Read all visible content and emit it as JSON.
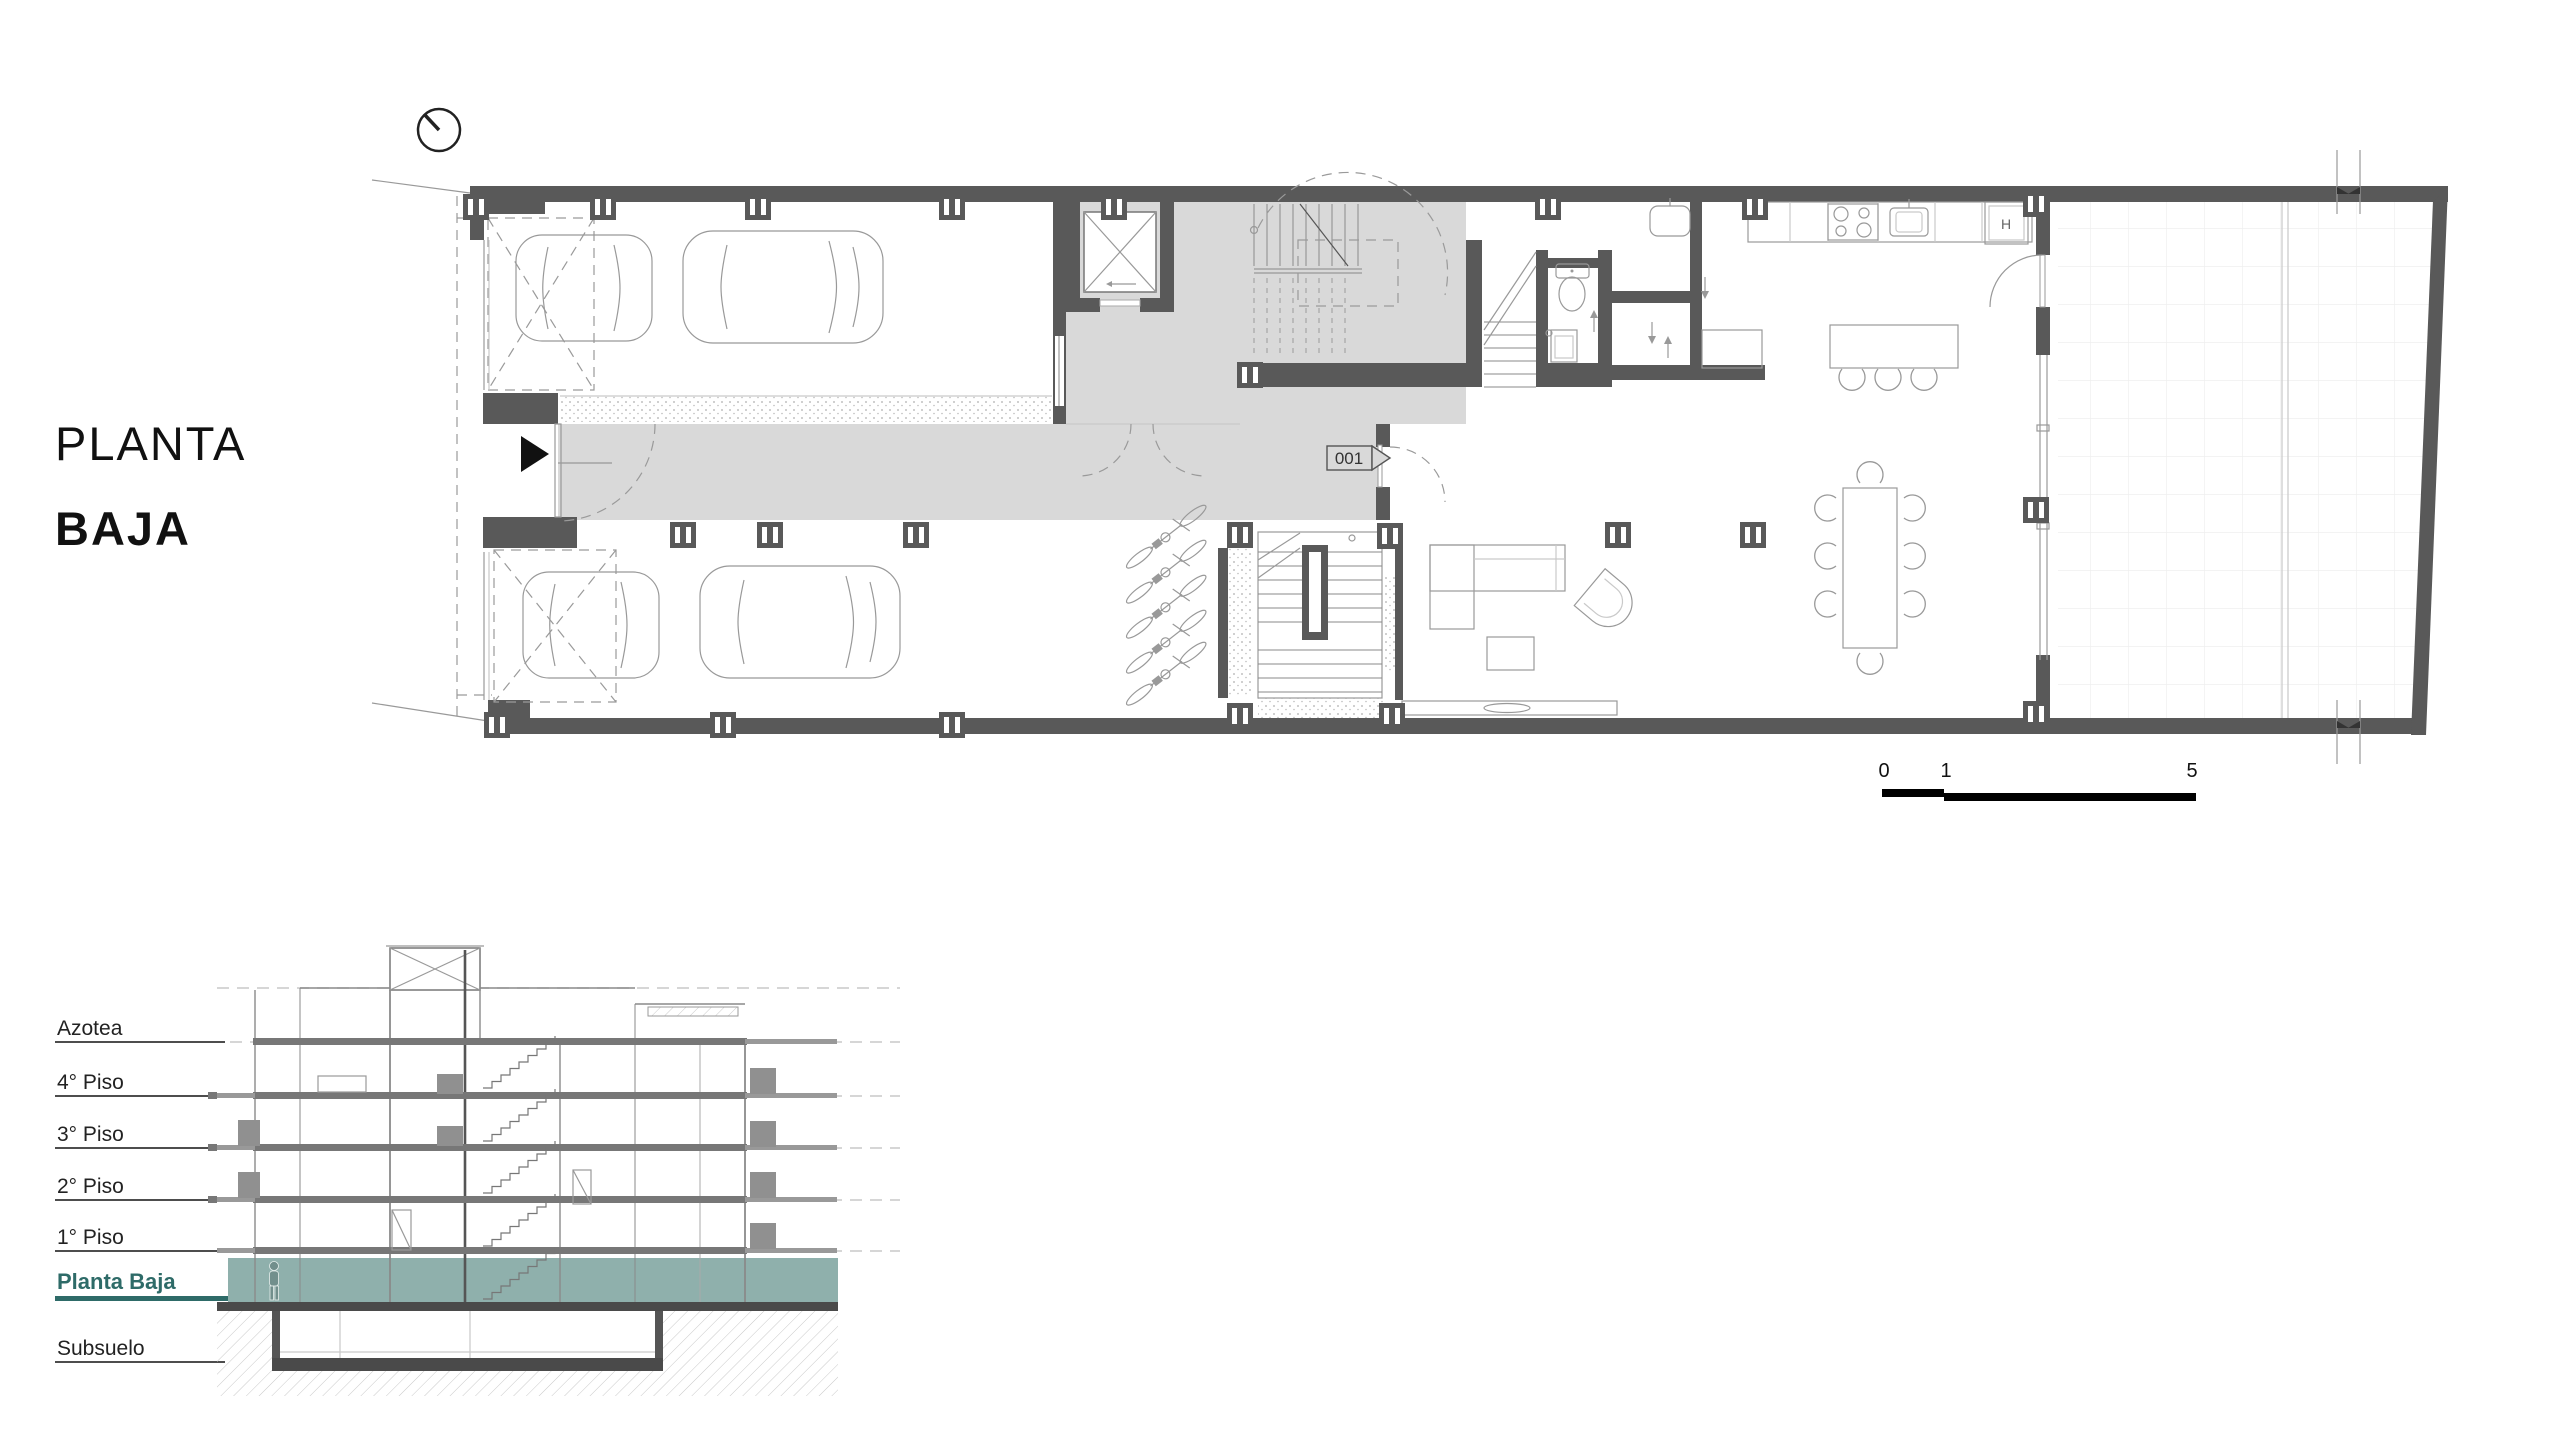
{
  "title": {
    "line1": "PLANTA",
    "line2": "BAJA"
  },
  "plan": {
    "room_tag": "001",
    "appliance_label": "H",
    "colors": {
      "wall": "#595959",
      "floor_gray": "#d9d9d9"
    }
  },
  "scale_bar": {
    "labels": [
      "0",
      "1",
      "5"
    ]
  },
  "section": {
    "levels": [
      {
        "label": "Azotea",
        "highlight": false
      },
      {
        "label": "4° Piso",
        "highlight": false
      },
      {
        "label": "3° Piso",
        "highlight": false
      },
      {
        "label": "2° Piso",
        "highlight": false
      },
      {
        "label": "1° Piso",
        "highlight": false
      },
      {
        "label": "Planta Baja",
        "highlight": true
      },
      {
        "label": "Subsuelo",
        "highlight": false
      }
    ],
    "highlight_color": "#2e6b68",
    "band_color": "#8fb0ac"
  }
}
